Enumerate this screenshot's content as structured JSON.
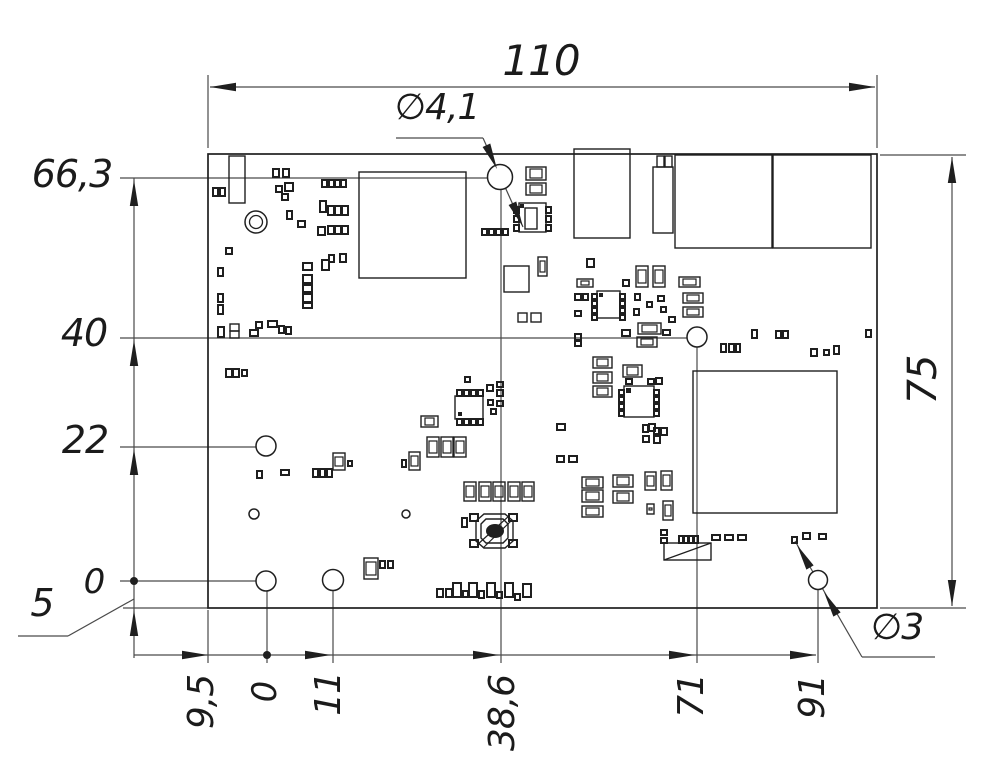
{
  "labels": {
    "t110": {
      "text": "110",
      "x": 541,
      "y": 61,
      "rot": 0,
      "size": 42
    },
    "r75": {
      "text": "75",
      "x": 923,
      "y": 380,
      "rot": -90,
      "size": 40
    },
    "l66_3": {
      "text": "66,3",
      "x": 72,
      "y": 174,
      "rot": 0,
      "size": 38
    },
    "l40": {
      "text": "40",
      "x": 84,
      "y": 333,
      "rot": 0,
      "size": 38
    },
    "l22": {
      "text": "22",
      "x": 85,
      "y": 440,
      "rot": 0,
      "size": 38
    },
    "l0": {
      "text": "0",
      "x": 94,
      "y": 582,
      "rot": 0,
      "size": 34
    },
    "l5": {
      "text": "5",
      "x": 42,
      "y": 603,
      "rot": 0,
      "size": 38
    },
    "phi41": {
      "text": "∅4,1",
      "x": 437,
      "y": 108,
      "rot": 0,
      "size": 36
    },
    "phi3": {
      "text": "∅3",
      "x": 897,
      "y": 628,
      "rot": 0,
      "size": 36
    },
    "b9_5": {
      "text": "9,5",
      "x": 202,
      "y": 702,
      "rot": -90,
      "size": 36
    },
    "b0": {
      "text": "0",
      "x": 265,
      "y": 692,
      "rot": -90,
      "size": 34
    },
    "b11": {
      "text": "11",
      "x": 329,
      "y": 694,
      "rot": -90,
      "size": 36
    },
    "b38_6": {
      "text": "38,6",
      "x": 503,
      "y": 713,
      "rot": -90,
      "size": 36
    },
    "b71": {
      "text": "71",
      "x": 692,
      "y": 696,
      "rot": -90,
      "size": 36
    },
    "b91": {
      "text": "91",
      "x": 813,
      "y": 697,
      "rot": -90,
      "size": 36
    }
  },
  "drawing": {
    "canvas": {
      "w": 1000,
      "h": 774,
      "ink": "#1f1f1f",
      "dim_ink": "#4a4a4a"
    },
    "board": {
      "x": 208,
      "y": 154,
      "w": 669,
      "h": 454
    },
    "holes": [
      [
        500,
        177,
        12.5
      ],
      [
        697,
        337,
        10
      ],
      [
        266,
        446,
        10
      ],
      [
        266,
        581,
        10
      ],
      [
        333,
        580,
        10.5
      ],
      [
        818,
        580,
        9.5
      ],
      [
        254,
        514,
        5
      ],
      [
        406,
        514,
        4
      ]
    ],
    "ring": [
      256,
      222,
      11,
      6.5
    ],
    "dots": [
      [
        134,
        581,
        4
      ],
      [
        267,
        655,
        4
      ]
    ],
    "lines": [
      [
        208,
        148,
        208,
        75
      ],
      [
        877,
        148,
        877,
        75
      ],
      [
        210,
        87,
        875,
        87
      ],
      [
        880,
        155,
        966,
        155
      ],
      [
        880,
        608,
        966,
        608
      ],
      [
        952,
        157,
        952,
        606
      ],
      [
        120,
        178,
        488,
        178
      ],
      [
        120,
        338,
        687,
        338
      ],
      [
        120,
        447,
        256,
        447
      ],
      [
        120,
        581,
        256,
        581
      ],
      [
        123,
        608,
        208,
        608
      ],
      [
        134,
        178,
        134,
        658
      ],
      [
        134,
        655,
        816,
        655
      ],
      [
        208,
        610,
        208,
        663
      ],
      [
        267,
        591,
        267,
        663
      ],
      [
        333,
        591,
        333,
        663
      ],
      [
        501,
        190,
        501,
        663
      ],
      [
        697,
        347,
        697,
        663
      ],
      [
        818,
        590,
        818,
        663
      ],
      [
        18,
        636,
        68,
        636
      ],
      [
        68,
        636,
        134,
        599
      ],
      [
        396,
        138,
        483,
        138
      ],
      [
        483,
        138,
        523,
        227
      ],
      [
        935,
        657,
        862,
        657
      ],
      [
        862,
        657,
        795,
        541
      ]
    ],
    "arrows": [
      [
        210,
        87,
        180
      ],
      [
        875,
        87,
        0
      ],
      [
        952,
        157,
        -90
      ],
      [
        952,
        606,
        90
      ],
      [
        134,
        180,
        -90
      ],
      [
        134,
        340,
        -90
      ],
      [
        134,
        449,
        -90
      ],
      [
        134,
        610,
        -90
      ],
      [
        208,
        655,
        0
      ],
      [
        331,
        655,
        0
      ],
      [
        499,
        655,
        0
      ],
      [
        695,
        655,
        0
      ],
      [
        816,
        655,
        0
      ],
      [
        497,
        169,
        66
      ],
      [
        523,
        227,
        66
      ],
      [
        824,
        592,
        -120
      ],
      [
        797,
        545,
        -120
      ]
    ],
    "rects": [
      [
        229,
        156,
        16,
        47
      ],
      [
        574,
        149,
        56,
        89
      ],
      [
        653,
        167,
        20,
        66
      ],
      [
        657,
        156,
        7,
        11
      ],
      [
        665,
        156,
        7,
        11
      ],
      [
        675,
        155,
        97,
        93
      ],
      [
        773,
        155,
        98,
        93
      ],
      [
        359,
        172,
        107,
        106
      ],
      [
        693,
        371,
        144,
        142
      ],
      [
        504,
        266,
        25,
        26
      ],
      [
        518,
        313,
        9,
        9
      ],
      [
        531,
        313,
        10,
        9
      ],
      [
        230,
        324,
        9,
        7
      ],
      [
        230,
        331,
        9,
        7
      ],
      [
        455,
        396,
        28,
        23
      ],
      [
        597,
        291,
        23,
        27
      ],
      [
        624,
        386,
        30,
        31
      ],
      [
        519,
        203,
        27,
        29
      ],
      [
        525,
        208,
        12,
        21
      ]
    ],
    "caps_h": [
      [
        526,
        167,
        20,
        13
      ],
      [
        526,
        183,
        20,
        12
      ],
      [
        577,
        279,
        16,
        8
      ],
      [
        679,
        277,
        21,
        10
      ],
      [
        683,
        293,
        20,
        10
      ],
      [
        683,
        307,
        20,
        10
      ],
      [
        638,
        323,
        23,
        11
      ],
      [
        637,
        337,
        20,
        10
      ],
      [
        421,
        416,
        17,
        11
      ],
      [
        582,
        477,
        21,
        11
      ],
      [
        582,
        490,
        21,
        12
      ],
      [
        582,
        506,
        21,
        11
      ],
      [
        613,
        475,
        20,
        12
      ],
      [
        613,
        491,
        20,
        12
      ],
      [
        593,
        357,
        19,
        11
      ],
      [
        593,
        372,
        19,
        11
      ],
      [
        593,
        386,
        19,
        11
      ],
      [
        623,
        365,
        19,
        12
      ]
    ],
    "caps_v": [
      [
        636,
        266,
        12,
        21
      ],
      [
        653,
        266,
        12,
        21
      ],
      [
        427,
        437,
        12,
        20
      ],
      [
        441,
        437,
        12,
        20
      ],
      [
        454,
        437,
        12,
        20
      ],
      [
        409,
        452,
        11,
        18
      ],
      [
        333,
        453,
        12,
        17
      ],
      [
        464,
        482,
        12,
        19
      ],
      [
        479,
        482,
        12,
        19
      ],
      [
        493,
        482,
        12,
        19
      ],
      [
        508,
        482,
        12,
        19
      ],
      [
        522,
        482,
        12,
        19
      ],
      [
        645,
        472,
        11,
        18
      ],
      [
        661,
        471,
        11,
        19
      ],
      [
        663,
        501,
        10,
        19
      ],
      [
        364,
        558,
        14,
        21
      ],
      [
        538,
        257,
        9,
        19
      ],
      [
        647,
        504,
        7,
        10
      ]
    ],
    "pads": [
      [
        273,
        169,
        6,
        8
      ],
      [
        283,
        169,
        6,
        8
      ],
      [
        213,
        188,
        5,
        8
      ],
      [
        220,
        188,
        5,
        8
      ],
      [
        276,
        186,
        6,
        6
      ],
      [
        285,
        183,
        8,
        8
      ],
      [
        322,
        180,
        5,
        7
      ],
      [
        329,
        180,
        5,
        7
      ],
      [
        335,
        180,
        5,
        7
      ],
      [
        341,
        180,
        5,
        7
      ],
      [
        282,
        194,
        6,
        6
      ],
      [
        320,
        201,
        6,
        11
      ],
      [
        328,
        206,
        6,
        9
      ],
      [
        335,
        206,
        6,
        9
      ],
      [
        342,
        206,
        6,
        9
      ],
      [
        287,
        211,
        5,
        8
      ],
      [
        298,
        221,
        7,
        6
      ],
      [
        318,
        227,
        7,
        8
      ],
      [
        328,
        226,
        6,
        8
      ],
      [
        335,
        226,
        6,
        8
      ],
      [
        342,
        226,
        6,
        8
      ],
      [
        226,
        248,
        6,
        6
      ],
      [
        218,
        268,
        5,
        8
      ],
      [
        303,
        263,
        9,
        7
      ],
      [
        303,
        275,
        9,
        8
      ],
      [
        303,
        285,
        9,
        7
      ],
      [
        303,
        294,
        9,
        8
      ],
      [
        303,
        303,
        9,
        5
      ],
      [
        322,
        260,
        7,
        10
      ],
      [
        329,
        255,
        5,
        7
      ],
      [
        340,
        254,
        6,
        8
      ],
      [
        218,
        294,
        5,
        8
      ],
      [
        218,
        305,
        5,
        9
      ],
      [
        218,
        327,
        6,
        10
      ],
      [
        250,
        330,
        8,
        6
      ],
      [
        256,
        322,
        6,
        6
      ],
      [
        268,
        321,
        9,
        6
      ],
      [
        279,
        326,
        5,
        7
      ],
      [
        286,
        327,
        5,
        7
      ],
      [
        226,
        369,
        6,
        8
      ],
      [
        233,
        369,
        6,
        8
      ],
      [
        242,
        370,
        5,
        6
      ],
      [
        257,
        471,
        5,
        7
      ],
      [
        281,
        470,
        8,
        5
      ],
      [
        313,
        469,
        5,
        8
      ],
      [
        320,
        469,
        5,
        8
      ],
      [
        327,
        469,
        5,
        8
      ],
      [
        348,
        461,
        4,
        5
      ],
      [
        402,
        460,
        4,
        7
      ],
      [
        462,
        518,
        5,
        9
      ],
      [
        457,
        390,
        5,
        6
      ],
      [
        464,
        390,
        5,
        6
      ],
      [
        471,
        390,
        5,
        6
      ],
      [
        478,
        390,
        5,
        6
      ],
      [
        457,
        419,
        5,
        6
      ],
      [
        464,
        419,
        5,
        6
      ],
      [
        471,
        419,
        5,
        6
      ],
      [
        478,
        419,
        5,
        6
      ],
      [
        465,
        377,
        5,
        5
      ],
      [
        487,
        385,
        6,
        6
      ],
      [
        497,
        382,
        6,
        5
      ],
      [
        497,
        390,
        6,
        6
      ],
      [
        488,
        400,
        5,
        5
      ],
      [
        497,
        401,
        6,
        5
      ],
      [
        491,
        409,
        5,
        5
      ],
      [
        557,
        424,
        8,
        6
      ],
      [
        557,
        456,
        7,
        6
      ],
      [
        569,
        456,
        8,
        6
      ],
      [
        514,
        207,
        5,
        6
      ],
      [
        514,
        216,
        5,
        6
      ],
      [
        514,
        225,
        5,
        6
      ],
      [
        546,
        207,
        5,
        6
      ],
      [
        546,
        216,
        5,
        6
      ],
      [
        546,
        225,
        5,
        6
      ],
      [
        482,
        229,
        5,
        6
      ],
      [
        489,
        229,
        5,
        6
      ],
      [
        496,
        229,
        5,
        6
      ],
      [
        503,
        229,
        5,
        6
      ],
      [
        592,
        294,
        5,
        5
      ],
      [
        592,
        301,
        5,
        5
      ],
      [
        592,
        308,
        5,
        5
      ],
      [
        592,
        315,
        5,
        5
      ],
      [
        620,
        294,
        5,
        5
      ],
      [
        620,
        301,
        5,
        5
      ],
      [
        620,
        308,
        5,
        5
      ],
      [
        620,
        315,
        5,
        5
      ],
      [
        575,
        294,
        6,
        6
      ],
      [
        583,
        294,
        5,
        6
      ],
      [
        575,
        311,
        6,
        5
      ],
      [
        587,
        259,
        7,
        8
      ],
      [
        623,
        280,
        6,
        6
      ],
      [
        635,
        294,
        5,
        6
      ],
      [
        634,
        309,
        5,
        6
      ],
      [
        647,
        302,
        5,
        5
      ],
      [
        658,
        296,
        6,
        5
      ],
      [
        661,
        307,
        5,
        5
      ],
      [
        669,
        317,
        6,
        5
      ],
      [
        619,
        390,
        5,
        5
      ],
      [
        619,
        397,
        5,
        5
      ],
      [
        619,
        404,
        5,
        5
      ],
      [
        619,
        411,
        5,
        5
      ],
      [
        654,
        390,
        5,
        5
      ],
      [
        654,
        397,
        5,
        5
      ],
      [
        654,
        404,
        5,
        5
      ],
      [
        654,
        411,
        5,
        5
      ],
      [
        626,
        379,
        6,
        5
      ],
      [
        648,
        379,
        6,
        5
      ],
      [
        656,
        378,
        6,
        6
      ],
      [
        643,
        425,
        5,
        7
      ],
      [
        649,
        424,
        6,
        7
      ],
      [
        643,
        436,
        6,
        6
      ],
      [
        654,
        428,
        5,
        6
      ],
      [
        661,
        428,
        6,
        7
      ],
      [
        654,
        436,
        6,
        7
      ],
      [
        575,
        334,
        6,
        6
      ],
      [
        575,
        341,
        6,
        5
      ],
      [
        622,
        330,
        8,
        6
      ],
      [
        663,
        330,
        7,
        5
      ],
      [
        752,
        330,
        5,
        8
      ],
      [
        776,
        331,
        5,
        7
      ],
      [
        783,
        331,
        5,
        7
      ],
      [
        866,
        330,
        5,
        7
      ],
      [
        721,
        344,
        5,
        8
      ],
      [
        729,
        344,
        5,
        8
      ],
      [
        736,
        344,
        4,
        8
      ],
      [
        811,
        349,
        6,
        7
      ],
      [
        824,
        350,
        5,
        5
      ],
      [
        834,
        346,
        5,
        8
      ],
      [
        679,
        536,
        4,
        7
      ],
      [
        684,
        536,
        4,
        7
      ],
      [
        689,
        536,
        4,
        7
      ],
      [
        694,
        536,
        4,
        7
      ],
      [
        712,
        535,
        8,
        5
      ],
      [
        725,
        535,
        8,
        5
      ],
      [
        738,
        535,
        8,
        5
      ],
      [
        661,
        530,
        6,
        5
      ],
      [
        661,
        538,
        6,
        5
      ],
      [
        792,
        537,
        5,
        6
      ],
      [
        803,
        533,
        7,
        6
      ],
      [
        819,
        534,
        7,
        5
      ],
      [
        437,
        589,
        6,
        8
      ],
      [
        446,
        589,
        6,
        8
      ],
      [
        453,
        583,
        8,
        14
      ],
      [
        463,
        591,
        5,
        6
      ],
      [
        469,
        583,
        8,
        14
      ],
      [
        479,
        591,
        5,
        7
      ],
      [
        487,
        583,
        8,
        14
      ],
      [
        497,
        592,
        5,
        6
      ],
      [
        505,
        583,
        8,
        14
      ],
      [
        515,
        594,
        5,
        6
      ],
      [
        523,
        584,
        8,
        13
      ],
      [
        380,
        561,
        5,
        7
      ],
      [
        388,
        561,
        5,
        7
      ]
    ],
    "fills": [
      [
        458,
        412,
        4,
        4
      ],
      [
        599,
        293,
        4,
        4
      ],
      [
        626,
        388,
        5,
        5
      ],
      [
        520,
        204,
        4,
        4
      ]
    ],
    "inductor": {
      "rect": [
        664,
        543,
        47,
        17
      ],
      "diag": [
        664,
        560,
        711,
        543
      ]
    },
    "crystal": {
      "polys": [
        "476,521 484,514 505,514 513,521 513,541 505,548 484,548 476,541",
        "481,524 486,519 503,519 508,524 508,538 503,543 486,543 481,538"
      ],
      "pads": [
        [
          470,
          514,
          8,
          7
        ],
        [
          509,
          514,
          8,
          7
        ],
        [
          470,
          540,
          8,
          7
        ],
        [
          509,
          540,
          8,
          7
        ]
      ],
      "ellipse": [
        495,
        531,
        9,
        7
      ],
      "lines": [
        [
          477,
          545,
          509,
          516
        ],
        [
          483,
          548,
          512,
          520
        ]
      ]
    }
  }
}
